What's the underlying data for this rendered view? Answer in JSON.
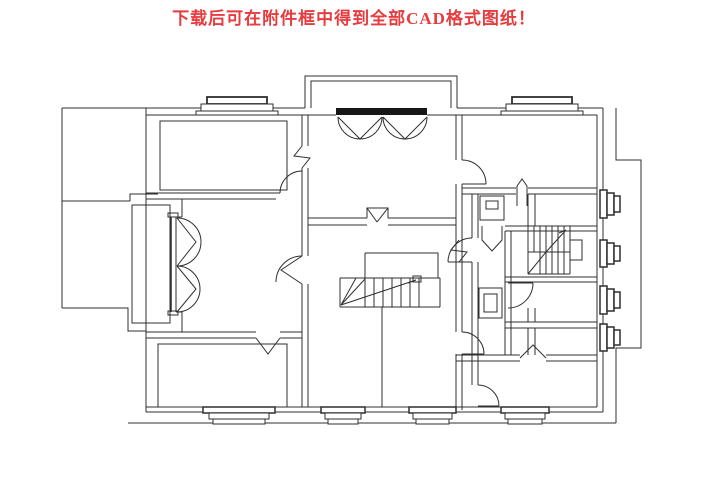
{
  "title": {
    "text": "下载后可在附件框中得到全部CAD格式图纸！"
  },
  "colors": {
    "background": "#ffffff",
    "title_red": "#e73c3f",
    "line": "#2f2f2f",
    "threshold_fill": "#161616"
  },
  "drawing": {
    "type": "floor-plan",
    "description": "Black-and-white CAD line drawing of a residential floor plan",
    "features": [
      "outer-walls",
      "entry-porch",
      "entry-double-doors",
      "left-balcony",
      "balcony-french-doors",
      "bedroom-top-left",
      "living-room",
      "entry-hall",
      "central-staircase",
      "secondary-staircase",
      "bathroom-cluster",
      "right-side-rooms",
      "bottom-rooms",
      "window-sills",
      "ac-window-units",
      "interior-door-swings"
    ],
    "window_sill_count": 6,
    "ac_unit_count": 4,
    "staircase_count": 2
  }
}
